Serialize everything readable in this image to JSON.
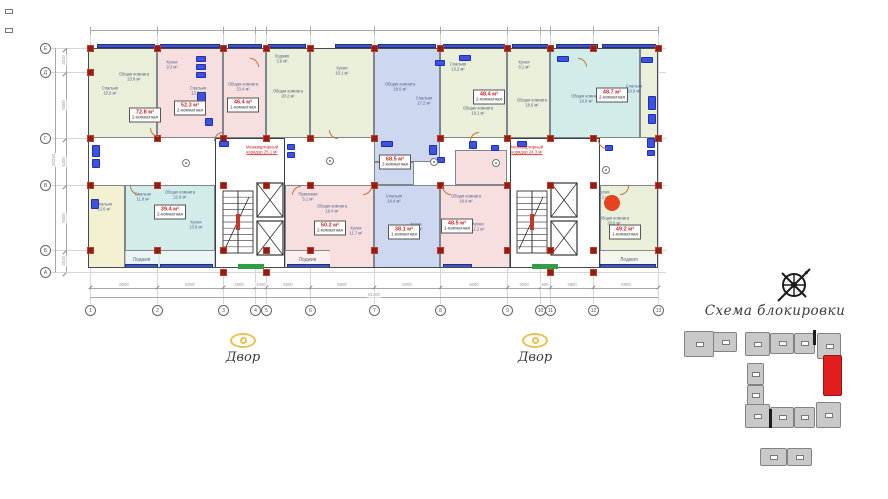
{
  "site_scheme": {
    "title": "Схема блокировки",
    "highlight_color": "#e11d1d",
    "block_color": "#c9c9c9",
    "blocks_gray": [
      [
        684,
        331,
        30,
        26
      ],
      [
        713,
        332,
        24,
        20
      ],
      [
        745,
        332,
        25,
        24
      ],
      [
        770,
        333,
        24,
        21
      ],
      [
        794,
        333,
        21,
        21
      ],
      [
        817,
        333,
        24,
        26
      ],
      [
        747,
        363,
        17,
        22
      ],
      [
        747,
        385,
        17,
        21
      ],
      [
        745,
        404,
        25,
        24
      ],
      [
        770,
        407,
        24,
        21
      ],
      [
        794,
        407,
        21,
        21
      ],
      [
        816,
        402,
        25,
        26
      ],
      [
        760,
        448,
        27,
        18
      ],
      [
        787,
        448,
        25,
        18
      ]
    ],
    "block_red": [
      823,
      355,
      19,
      41
    ],
    "ticks": [
      [
        813,
        330,
        3,
        15
      ],
      [
        769,
        409,
        3,
        19
      ]
    ],
    "red_windows": [
      [
        828,
        364,
        8,
        5
      ],
      [
        828,
        383,
        8,
        5
      ]
    ]
  },
  "courtyards": [
    {
      "x": 243,
      "y": 333,
      "label": "Двор"
    },
    {
      "x": 535,
      "y": 333,
      "label": "Двор"
    }
  ],
  "floorplan": {
    "grid_x": [
      {
        "pos": 90,
        "label": "1"
      },
      {
        "pos": 157,
        "label": "2"
      },
      {
        "pos": 223,
        "label": "3"
      },
      {
        "pos": 255,
        "label": "4"
      },
      {
        "pos": 266,
        "label": "5"
      },
      {
        "pos": 310,
        "label": "6"
      },
      {
        "pos": 374,
        "label": "7"
      },
      {
        "pos": 440,
        "label": "8"
      },
      {
        "pos": 507,
        "label": "9"
      },
      {
        "pos": 540,
        "label": "10"
      },
      {
        "pos": 550,
        "label": "11"
      },
      {
        "pos": 593,
        "label": "12"
      },
      {
        "pos": 658,
        "label": "13"
      }
    ],
    "grid_y": [
      {
        "pos": 48,
        "label": "Е"
      },
      {
        "pos": 72,
        "label": "Д"
      },
      {
        "pos": 138,
        "label": "Г"
      },
      {
        "pos": 185,
        "label": "В"
      },
      {
        "pos": 250,
        "label": "Б"
      },
      {
        "pos": 272,
        "label": "А"
      }
    ],
    "dims_bottom": [
      "6000",
      "6000",
      "2900",
      "1000",
      "4000",
      "5800",
      "6000",
      "6000",
      "3000",
      "900",
      "3900",
      "5900"
    ],
    "dims_left": [
      "2010",
      "6000",
      "4200",
      "6000",
      "2010"
    ],
    "total_bottom": "51400",
    "total_left": "20220",
    "colors": {
      "green": "#e9efd8",
      "pink": "#f7dfdf",
      "blue": "#cdd7f0",
      "cyan": "#d2ecea",
      "yellow": "#f4f0d2"
    },
    "units": [
      [
        88,
        48,
        69,
        90,
        "green"
      ],
      [
        157,
        48,
        66,
        90,
        "pink"
      ],
      [
        223,
        48,
        43,
        90,
        "pink"
      ],
      [
        266,
        48,
        44,
        90,
        "green"
      ],
      [
        310,
        48,
        64,
        90,
        "green"
      ],
      [
        374,
        48,
        66,
        114,
        "blue"
      ],
      [
        440,
        48,
        67,
        90,
        "green"
      ],
      [
        507,
        48,
        43,
        90,
        "green"
      ],
      [
        550,
        48,
        90,
        90,
        "cyan"
      ],
      [
        640,
        48,
        18,
        90,
        "green"
      ],
      [
        88,
        185,
        37,
        83,
        "yellow"
      ],
      [
        125,
        185,
        90,
        83,
        "cyan"
      ],
      [
        285,
        185,
        89,
        83,
        "pink"
      ],
      [
        374,
        185,
        66,
        83,
        "blue"
      ],
      [
        440,
        185,
        70,
        83,
        "pink"
      ],
      [
        600,
        185,
        58,
        83,
        "green"
      ]
    ],
    "patches": [
      [
        374,
        162,
        40,
        23,
        "blue"
      ],
      [
        455,
        150,
        52,
        35,
        "pink"
      ]
    ],
    "loggias": [
      [
        125,
        250,
        33,
        18,
        "Лоджия"
      ],
      [
        160,
        250,
        55,
        18,
        ""
      ],
      [
        285,
        250,
        45,
        18,
        "Лоджия"
      ],
      [
        600,
        250,
        58,
        18,
        "Лоджия"
      ]
    ],
    "cores": [
      {
        "x": 215,
        "y": 138,
        "w": 70,
        "h": 130,
        "stair": [
          7,
          52,
          30,
          62
        ],
        "elev": [
          [
            41,
            44,
            26,
            34
          ],
          [
            41,
            82,
            26,
            34
          ]
        ]
      },
      {
        "x": 510,
        "y": 138,
        "w": 90,
        "h": 130,
        "stair": [
          6,
          52,
          30,
          62
        ],
        "elev": [
          [
            40,
            44,
            26,
            34
          ],
          [
            40,
            82,
            26,
            34
          ]
        ]
      }
    ],
    "columns": {
      "xs": [
        90,
        157,
        223,
        266,
        310,
        374,
        440,
        507,
        550,
        593,
        658
      ],
      "ys": [
        48,
        138,
        185,
        250
      ],
      "extra": [
        [
          90,
          72
        ],
        [
          223,
          272
        ],
        [
          266,
          272
        ],
        [
          550,
          272
        ],
        [
          593,
          272
        ]
      ]
    },
    "glazing_top": [
      [
        97,
        58
      ],
      [
        160,
        60
      ],
      [
        228,
        34
      ],
      [
        268,
        38
      ],
      [
        335,
        37
      ],
      [
        378,
        58
      ],
      [
        443,
        62
      ],
      [
        512,
        36
      ],
      [
        556,
        42
      ],
      [
        602,
        54
      ]
    ],
    "glazing_bottom": [
      [
        125,
        33
      ],
      [
        160,
        53
      ],
      [
        287,
        43
      ],
      [
        443,
        29
      ],
      [
        600,
        56
      ]
    ],
    "fixtures": [
      [
        92,
        145,
        8,
        12
      ],
      [
        92,
        159,
        8,
        9
      ],
      [
        196,
        56,
        10,
        6
      ],
      [
        196,
        64,
        10,
        6
      ],
      [
        196,
        72,
        10,
        6
      ],
      [
        197,
        92,
        9,
        14
      ],
      [
        205,
        118,
        8,
        8
      ],
      [
        287,
        144,
        8,
        6
      ],
      [
        287,
        152,
        8,
        6
      ],
      [
        381,
        141,
        12,
        6
      ],
      [
        429,
        145,
        8,
        10
      ],
      [
        437,
        157,
        8,
        6
      ],
      [
        459,
        55,
        12,
        6
      ],
      [
        469,
        141,
        8,
        8
      ],
      [
        491,
        145,
        8,
        6
      ],
      [
        557,
        56,
        12,
        6
      ],
      [
        641,
        57,
        12,
        6
      ],
      [
        648,
        96,
        8,
        14
      ],
      [
        648,
        114,
        8,
        10
      ],
      [
        647,
        138,
        8,
        10
      ],
      [
        647,
        150,
        8,
        6
      ],
      [
        219,
        141,
        10,
        6
      ],
      [
        517,
        141,
        10,
        6
      ],
      [
        605,
        145,
        8,
        6
      ],
      [
        91,
        199,
        8,
        10
      ],
      [
        435,
        60,
        10,
        6
      ]
    ],
    "doors": [
      [
        150,
        128,
        0
      ],
      [
        214,
        132,
        90
      ],
      [
        250,
        58,
        180
      ],
      [
        329,
        130,
        0
      ],
      [
        363,
        186,
        270
      ],
      [
        442,
        186,
        0
      ],
      [
        470,
        132,
        90
      ],
      [
        598,
        140,
        0
      ],
      [
        620,
        186,
        270
      ],
      [
        130,
        186,
        0
      ],
      [
        578,
        58,
        180
      ],
      [
        292,
        186,
        90
      ]
    ],
    "pins": [
      [
        186,
        163
      ],
      [
        330,
        161
      ],
      [
        434,
        162
      ],
      [
        496,
        163
      ],
      [
        606,
        170
      ]
    ],
    "unit_labels": [
      [
        145,
        115,
        "72.8 м²",
        "2-комнатная"
      ],
      [
        190,
        108,
        "52.3 м²",
        "2-комнатная"
      ],
      [
        243,
        105,
        "46.4 м²",
        "1-комнатная"
      ],
      [
        395,
        162,
        "68.5 м²",
        "2-комнатная"
      ],
      [
        489,
        97,
        "48.4 м²",
        "2-комнатная"
      ],
      [
        612,
        95,
        "48.7 м²",
        "2-комнатная"
      ],
      [
        170,
        212,
        "39.4 м²",
        "2-комнатная"
      ],
      [
        330,
        228,
        "50.2 м²",
        "2-комнатная"
      ],
      [
        404,
        232,
        "38.1 м²",
        "1-комнатная"
      ],
      [
        457,
        226,
        "48.5 м²",
        "1-комнатная"
      ],
      [
        625,
        232,
        "49.2 м²",
        "1-комнатная"
      ]
    ],
    "room_labels": [
      [
        110,
        92,
        "Спальня",
        "15.6 м²"
      ],
      [
        134,
        78,
        "Общая комната",
        "23.8 м²"
      ],
      [
        172,
        66,
        "Кухня",
        "9.3 м²"
      ],
      [
        198,
        92,
        "Спальня",
        "13.2 м²"
      ],
      [
        243,
        88,
        "Общая комната",
        "23.4 м²"
      ],
      [
        288,
        95,
        "Общая комната",
        "20.2 м²"
      ],
      [
        282,
        60,
        "Лоджия",
        "3.6 м²"
      ],
      [
        342,
        72,
        "Кухня",
        "10.1 м²"
      ],
      [
        400,
        88,
        "Общая комната",
        "18.6 м²"
      ],
      [
        424,
        102,
        "Спальня",
        "17.2 м²"
      ],
      [
        458,
        68,
        "Спальня",
        "13.2 м²"
      ],
      [
        478,
        112,
        "Общая комната",
        "19.1 м²"
      ],
      [
        524,
        66,
        "Кухня",
        "8.1 м²"
      ],
      [
        532,
        104,
        "Общая комната",
        "18.6 м²"
      ],
      [
        586,
        100,
        "Общая комната",
        "19.8 м²"
      ],
      [
        634,
        90,
        "Спальня",
        "10.9 м²"
      ],
      [
        104,
        208,
        "Спальня",
        "13.6 м²"
      ],
      [
        143,
        198,
        "Спальня",
        "11.8 м²"
      ],
      [
        180,
        196,
        "Общая комната",
        "22.8 м²"
      ],
      [
        196,
        226,
        "Кухня",
        "13.8 м²"
      ],
      [
        308,
        198,
        "Прихожая",
        "5.1 м²"
      ],
      [
        332,
        210,
        "Общая комната",
        "19.4 м²"
      ],
      [
        356,
        232,
        "Кухня",
        "11.7 м²"
      ],
      [
        394,
        200,
        "Спальня",
        "16.4 м²"
      ],
      [
        416,
        228,
        "Кухня",
        "13.2 м²"
      ],
      [
        466,
        200,
        "Общая комната",
        "18.4 м²"
      ],
      [
        478,
        228,
        "Кухня",
        "11.2 м²"
      ],
      [
        614,
        222,
        "Общая комната",
        "20.6 м²"
      ],
      [
        604,
        196,
        "Кухня",
        "9.1 м²"
      ]
    ],
    "corridor_labels": [
      [
        262,
        150,
        "Межквартирный",
        "коридор 25.1 м²"
      ],
      [
        527,
        150,
        "Межквартирный",
        "коридор 24.3 м²"
      ]
    ],
    "entrances": [
      [
        238,
        264,
        26,
        5
      ],
      [
        532,
        264,
        26,
        5
      ]
    ],
    "red_marker": {
      "x": 612,
      "y": 203,
      "r": 8,
      "color": "#e8431f"
    }
  }
}
